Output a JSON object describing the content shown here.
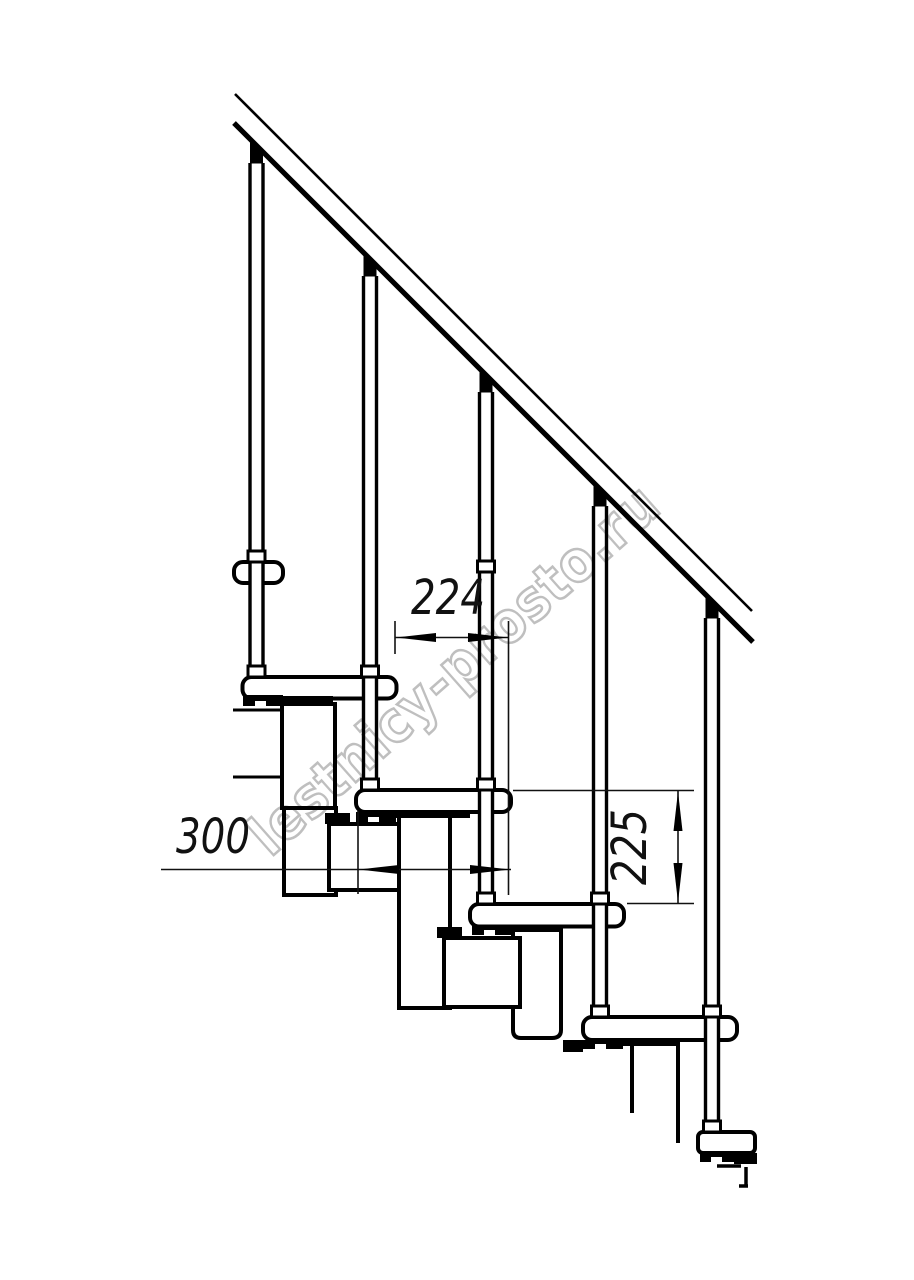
{
  "drawing": {
    "type": "staircase-elevation-technical-drawing",
    "dimensions": {
      "step_run": "224",
      "tread_depth": "300",
      "step_rise": "225"
    },
    "watermark": {
      "text": "lestnicy-prosto.ru"
    },
    "colors": {
      "line": "#000000",
      "background": "#ffffff",
      "watermark": "#b4b4b4"
    }
  }
}
